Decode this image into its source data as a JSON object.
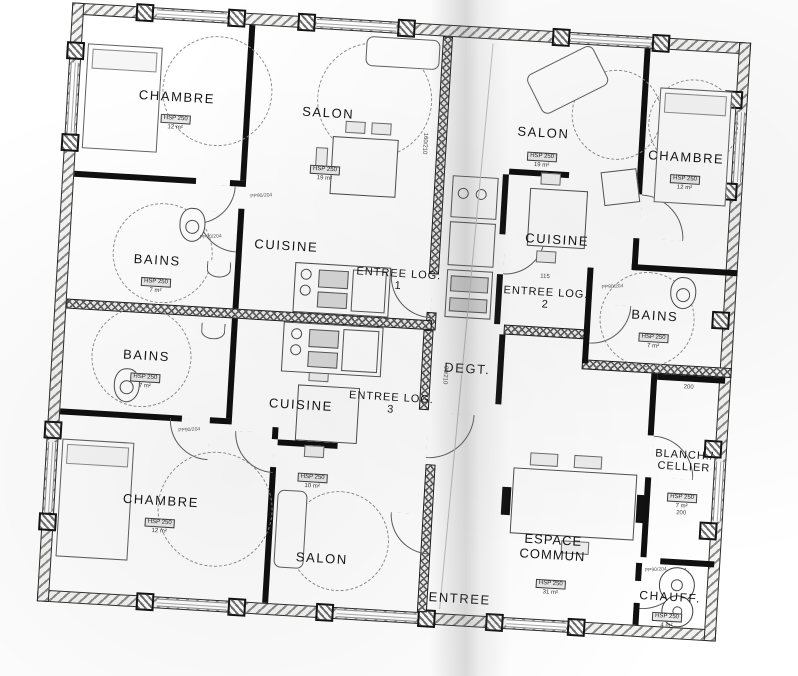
{
  "plan": {
    "rooms": {
      "chambre1": {
        "name": "CHAMBRE",
        "hsp": "HSP 250",
        "area": "12 m²"
      },
      "salon1": {
        "name": "SALON",
        "hsp": "HSP 250",
        "area": "19 m²"
      },
      "bains1": {
        "name": "BAINS",
        "hsp": "HSP 250",
        "area": "7 m²"
      },
      "cuisine1": {
        "name": "CUISINE"
      },
      "entree1": {
        "name": "ENTREE LOG. 1"
      },
      "salon2": {
        "name": "SALON",
        "hsp": "HSP 250",
        "area": "19 m²"
      },
      "cuisine2": {
        "name": "CUISINE"
      },
      "chambre2": {
        "name": "CHAMBRE",
        "hsp": "HSP 250",
        "area": "12 m²"
      },
      "bains2": {
        "name": "BAINS",
        "hsp": "HSP 250",
        "area": "7 m²"
      },
      "entree2": {
        "name": "ENTREE LOG. 2"
      },
      "bains3": {
        "name": "BAINS",
        "hsp": "HSP 250",
        "area": "7 m²"
      },
      "cuisine3": {
        "name": "CUISINE",
        "hsp": "HSP 250",
        "area": "10 m²"
      },
      "entree3": {
        "name": "ENTREE LOG. 3"
      },
      "degt": {
        "name": "DEGT."
      },
      "chambre3": {
        "name": "CHAMBRE",
        "hsp": "HSP 250",
        "area": "12 m²"
      },
      "salon3": {
        "name": "SALON"
      },
      "entree_main": {
        "name": "ENTREE"
      },
      "espace_commun": {
        "name": "ESPACE COMMUN",
        "hsp": "HSP 250",
        "area": "31 m²"
      },
      "blanch": {
        "name": "BLANCH./ CELLIER",
        "hsp": "HSP 250",
        "area": "7 m²"
      },
      "chauff": {
        "name": "CHAUFF.",
        "hsp": "HSP 250",
        "area": "4 m²"
      }
    },
    "annotations": {
      "door_code": "PP90/204",
      "dim_115": "115",
      "dim_200a": "200",
      "dim_200b": "200",
      "dim_door_90": "90/210",
      "dim_door_160": "160/210"
    }
  }
}
